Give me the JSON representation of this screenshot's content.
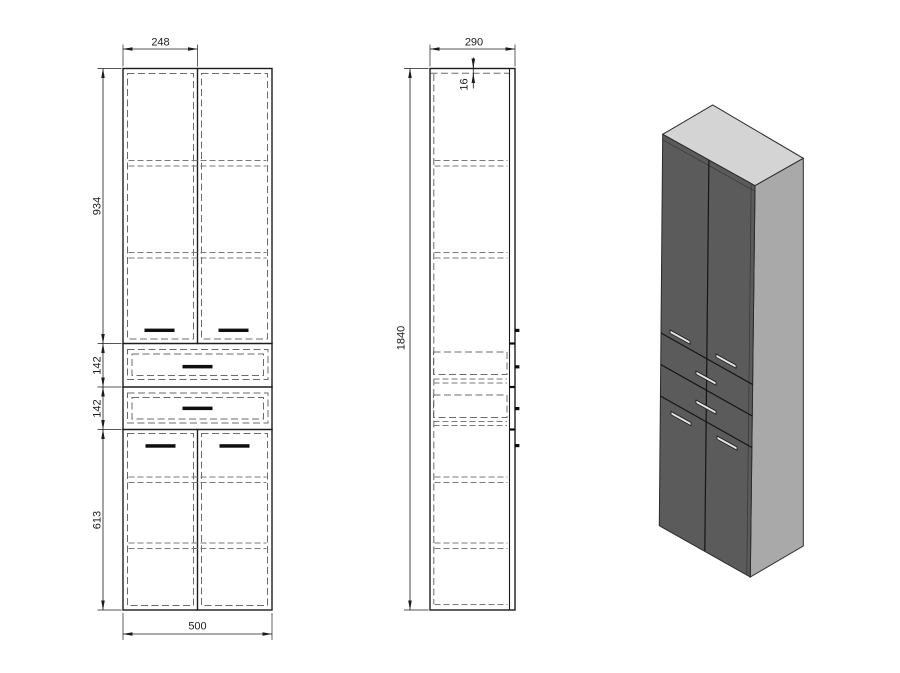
{
  "front_view": {
    "dims": {
      "door_width": "248",
      "upper_section_height": "934",
      "upper_drawer_height": "142",
      "lower_drawer_height": "142",
      "lower_section_height": "613",
      "total_width": "500"
    }
  },
  "side_view": {
    "dims": {
      "depth": "290",
      "top_panel_thickness": "16",
      "total_height": "1840"
    }
  },
  "iso_view": {
    "colors": {
      "front_face": "#5b5b5b",
      "side_face": "#a9a9a9",
      "top_face": "#d4d4d4",
      "handle": "#e3e3e3"
    }
  }
}
